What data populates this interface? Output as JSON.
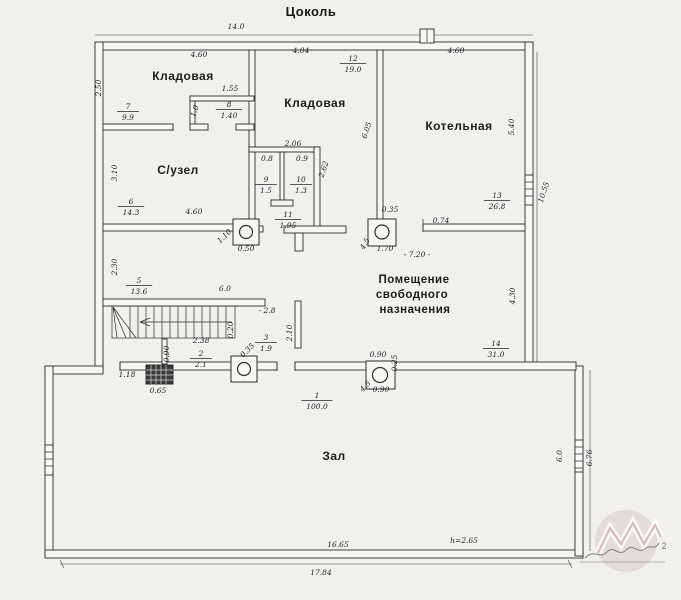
{
  "title": "Цоколь",
  "plan": {
    "room_labels": [
      {
        "id": "floor-title",
        "t": "Цоколь",
        "x": 311,
        "y": 16,
        "fs": 13,
        "cls": "title"
      },
      {
        "id": "room-kladovaya-left",
        "t": "Кладовая",
        "x": 183,
        "y": 80,
        "fs": 12
      },
      {
        "id": "room-kladovaya-center",
        "t": "Кладовая",
        "x": 315,
        "y": 107,
        "fs": 12
      },
      {
        "id": "room-kotelnaya",
        "t": "Котельная",
        "x": 459,
        "y": 130,
        "fs": 12
      },
      {
        "id": "room-suzel",
        "t": "С/узел",
        "x": 178,
        "y": 174,
        "fs": 12
      },
      {
        "id": "room-pomeshenie-1",
        "t": "Помещение",
        "x": 414,
        "y": 283,
        "fs": 11.5
      },
      {
        "id": "room-pomeshenie-2",
        "t": "свободного",
        "x": 412,
        "y": 298,
        "fs": 11.5
      },
      {
        "id": "room-pomeshenie-3",
        "t": "назначения",
        "x": 415,
        "y": 313,
        "fs": 11.5
      },
      {
        "id": "room-zal",
        "t": "Зал",
        "x": 334,
        "y": 460,
        "fs": 12
      }
    ],
    "room_tags": [
      {
        "num": "7",
        "area": "9.9",
        "x": 128,
        "y": 110
      },
      {
        "num": "12",
        "area": "19.0",
        "x": 353,
        "y": 62
      },
      {
        "num": "8",
        "area": "1.40",
        "x": 229,
        "y": 108
      },
      {
        "num": "6",
        "area": "14.3",
        "x": 131,
        "y": 205
      },
      {
        "num": "9",
        "area": "1.5",
        "x": 266,
        "y": 183
      },
      {
        "num": "10",
        "area": "1.3",
        "x": 301,
        "y": 183
      },
      {
        "num": "11",
        "area": "1.95",
        "x": 288,
        "y": 218
      },
      {
        "num": "5",
        "area": "13.6",
        "x": 139,
        "y": 284
      },
      {
        "num": "3",
        "area": "1.9",
        "x": 266,
        "y": 341
      },
      {
        "num": "2",
        "area": "2.1",
        "x": 201,
        "y": 357
      },
      {
        "num": "13",
        "area": "26.8",
        "x": 497,
        "y": 199
      },
      {
        "num": "14",
        "area": "31.0",
        "x": 496,
        "y": 347
      },
      {
        "num": "1",
        "area": "100.0",
        "x": 317,
        "y": 399
      }
    ],
    "dimensions": [
      {
        "t": "14.0",
        "x": 236,
        "y": 29
      },
      {
        "t": "4.60",
        "x": 199,
        "y": 57
      },
      {
        "t": "4.04",
        "x": 301,
        "y": 53
      },
      {
        "t": "4.60",
        "x": 456,
        "y": 53
      },
      {
        "t": "2.50",
        "x": 101,
        "y": 88,
        "r": -90
      },
      {
        "t": "1.55",
        "x": 230,
        "y": 91
      },
      {
        "t": "1.0",
        "x": 197,
        "y": 112,
        "r": -70
      },
      {
        "t": "3.10",
        "x": 117,
        "y": 173,
        "r": -90
      },
      {
        "t": "2.06",
        "x": 293,
        "y": 146
      },
      {
        "t": "0.8",
        "x": 267,
        "y": 161
      },
      {
        "t": "0.9",
        "x": 302,
        "y": 161
      },
      {
        "t": "2.62",
        "x": 326,
        "y": 170,
        "r": -72
      },
      {
        "t": "6.05",
        "x": 369,
        "y": 131,
        "r": -72
      },
      {
        "t": "5.40",
        "x": 514,
        "y": 127,
        "r": -90
      },
      {
        "t": "10.55",
        "x": 546,
        "y": 193,
        "r": -72
      },
      {
        "t": "4.60",
        "x": 194,
        "y": 214
      },
      {
        "t": "0.35",
        "x": 390,
        "y": 212
      },
      {
        "t": "0.74",
        "x": 441,
        "y": 223
      },
      {
        "t": "1.10",
        "x": 226,
        "y": 238,
        "r": -45
      },
      {
        "t": "0.50",
        "x": 246,
        "y": 251
      },
      {
        "t": "1.70",
        "x": 385,
        "y": 251
      },
      {
        "t": "4.5",
        "x": 367,
        "y": 245,
        "r": -60
      },
      {
        "t": "- 7.20 -",
        "x": 417,
        "y": 257
      },
      {
        "t": "2.30",
        "x": 117,
        "y": 267,
        "r": -90
      },
      {
        "t": "6.0",
        "x": 225,
        "y": 291
      },
      {
        "t": "- 2.8",
        "x": 267,
        "y": 313
      },
      {
        "t": "4.30",
        "x": 515,
        "y": 296,
        "r": -90
      },
      {
        "t": "2.10",
        "x": 292,
        "y": 333,
        "r": -90
      },
      {
        "t": "0.20",
        "x": 233,
        "y": 330,
        "r": -90
      },
      {
        "t": "2.38",
        "x": 201,
        "y": 343
      },
      {
        "t": "0.90",
        "x": 169,
        "y": 354,
        "r": -90
      },
      {
        "t": "0.35",
        "x": 249,
        "y": 352,
        "r": -45
      },
      {
        "t": "1.18",
        "x": 127,
        "y": 377
      },
      {
        "t": "0.65",
        "x": 158,
        "y": 393
      },
      {
        "t": "0.90",
        "x": 378,
        "y": 357
      },
      {
        "t": "0.25",
        "x": 397,
        "y": 363,
        "r": -90
      },
      {
        "t": "0.90",
        "x": 381,
        "y": 392
      },
      {
        "t": "4.5",
        "x": 367,
        "y": 388,
        "r": -45
      },
      {
        "t": "6.0",
        "x": 562,
        "y": 456,
        "r": -90
      },
      {
        "t": "6.76",
        "x": 592,
        "y": 458,
        "r": -90
      },
      {
        "t": "16.65",
        "x": 338,
        "y": 547
      },
      {
        "t": "h=2.65",
        "x": 464,
        "y": 543
      },
      {
        "t": "17.84",
        "x": 321,
        "y": 575
      }
    ]
  },
  "watermark": {
    "superscript": "2"
  }
}
